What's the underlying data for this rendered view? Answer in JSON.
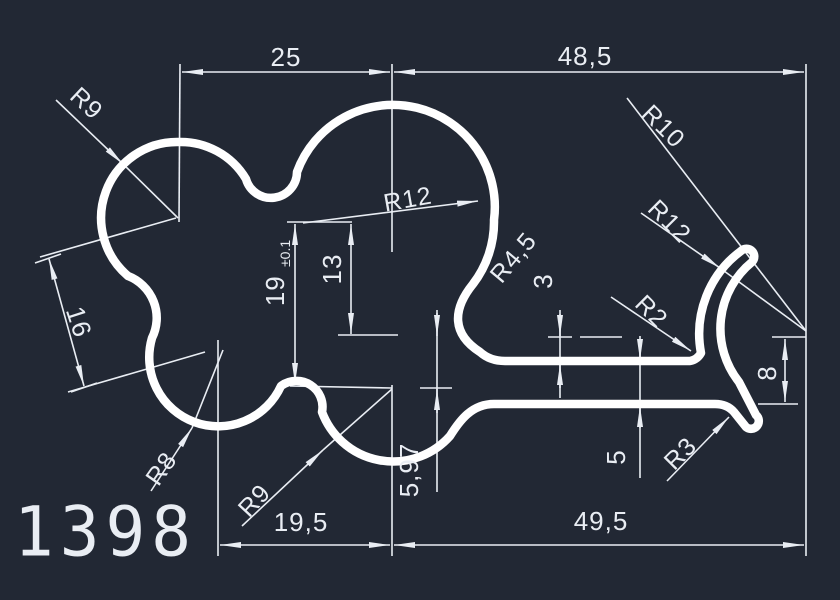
{
  "drawing": {
    "part_number": "1398",
    "colors": {
      "background": "#222834",
      "profile_line": "#ffffff",
      "dimension_line": "#e9edf3",
      "text": "#e9edf3"
    },
    "dim_labels": {
      "top_width": "25",
      "top_width_right": "48,5",
      "bottom_width_left": "19,5",
      "bottom_width_right": "49,5",
      "height_19": "19",
      "height_19_tolerance": "±0.1",
      "height_13": "13",
      "width_16": "16",
      "height_8": "8",
      "thickness_5": "5",
      "thickness_3": "3",
      "height_5_97": "5,97",
      "radius_r9_top": "R9",
      "radius_r12_middle": "R12",
      "radius_r10": "R10",
      "radius_r12_right": "R12",
      "radius_r4_5": "R4,5",
      "radius_r2": "R2",
      "radius_r3": "R3",
      "radius_r8": "R8",
      "radius_r9_bottom": "R9"
    }
  }
}
